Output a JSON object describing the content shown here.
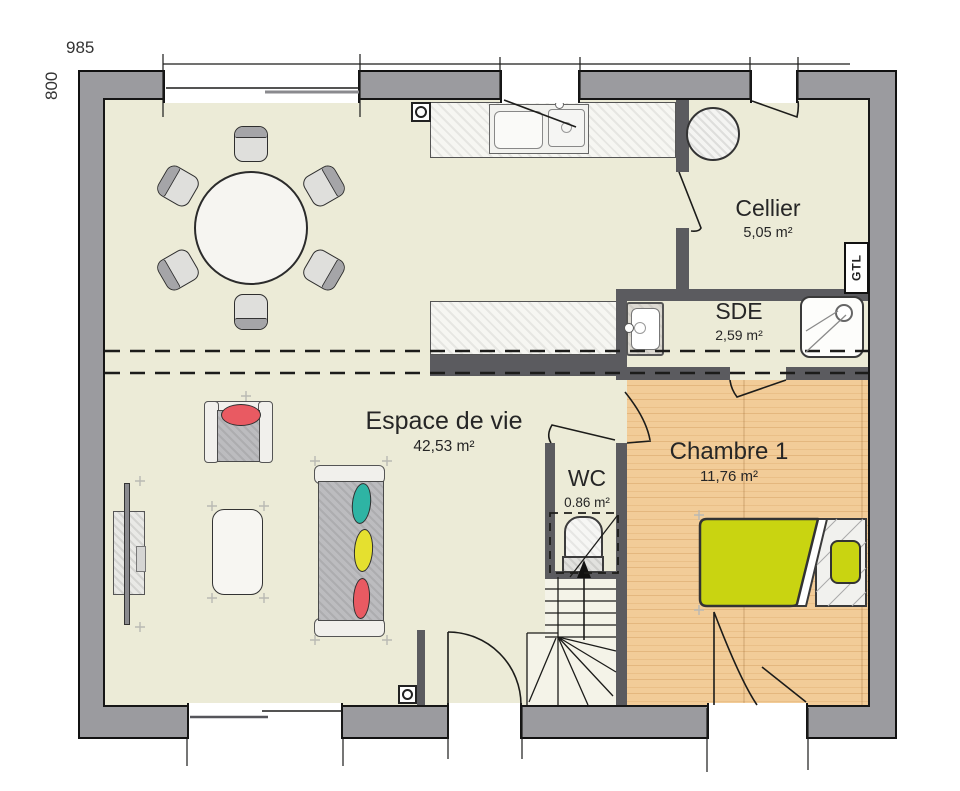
{
  "dimensions": {
    "top": "985",
    "left": "800"
  },
  "rooms": [
    {
      "name": "Cellier",
      "area": "5,05 m²"
    },
    {
      "name": "SDE",
      "area": "2,59 m²"
    },
    {
      "name": "Espace de vie",
      "area": "42,53 m²"
    },
    {
      "name": "WC",
      "area": "0.86 m²"
    },
    {
      "name": "Chambre 1",
      "area": "11,76 m²"
    }
  ],
  "labels": {
    "gtl": "GTL"
  },
  "colors": {
    "page": "#ffffff",
    "floor": "#ecebd7",
    "floor-stairs": "#f4f3e8",
    "wood": "#f2cc98",
    "wood-grain": "#e4b77e",
    "wall-outer": "#9b9b9f",
    "wall-inner": "#5b5b5f",
    "line": "#1c1c1a",
    "duvet": "#c9d411",
    "cushion-teal": "#2eb4a4",
    "cushion-yellow": "#e5e02f",
    "cushion-red": "#e95a62",
    "furniture-gray": "#bcbcbf",
    "furniture-light": "#f1f0ec"
  }
}
